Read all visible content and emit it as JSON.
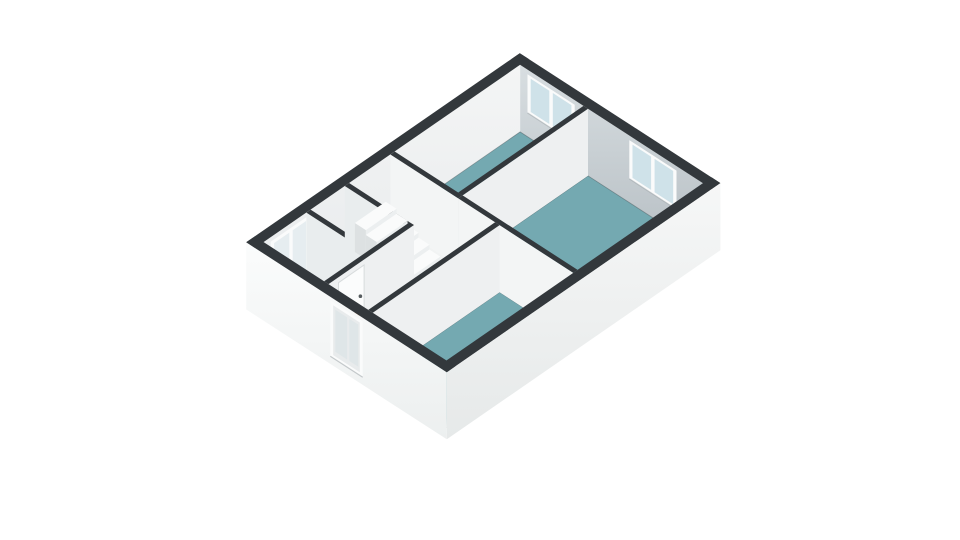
{
  "scene": {
    "background": "#ffffff",
    "type": "3d-floorplan-render"
  },
  "building": {
    "length_m": 9.6,
    "width_m": 6.8,
    "wall_height_m": 2.2,
    "exterior_wall_thickness_m": 0.3,
    "interior_wall_thickness_m": 0.15
  },
  "colors": {
    "wallTop": "#33383c",
    "teal": "#74a9b1",
    "floorWhite": "#f1f3f3",
    "floorEdge": "#3d464b",
    "faceBright": "#f3f5f5",
    "faceSouth": "#eef0f1",
    "faceWest": "#e9edee",
    "innerHi": "#d8dee1",
    "innerLo": "#b7bfc4",
    "y0Hi": "#f4f5f5",
    "y0Lo": "#e7eaec",
    "outerHi": "#fbfcfc",
    "outerLo": "#ecefef",
    "outer2Hi": "#f6f7f7",
    "outer2Lo": "#e6e9e9",
    "frame": "#fafbfb",
    "glass": "#cfe2e9",
    "glassLight": "#e6edf0",
    "paleGlass": "#dfe6e8",
    "sill": "#9aa2a6",
    "stripFill": "#edeff0",
    "seam": "#d9dddf",
    "stepTop": "#fafbfb",
    "stepFront": "#eceff0",
    "stepSide": "#dde1e2",
    "washTop": "#f3f5f5",
    "washFront": "#fdfdfd",
    "washSide": "#e9eced",
    "ringOuter": "#dfe3e4",
    "ringMid": "#97a1a5",
    "ringCore": "#c8cfd1",
    "leaf": "#fbfcfc",
    "leafEdge": "#d7dbdc",
    "handle": "#565c5f",
    "doorOrange": "#e08a3c"
  },
  "rooms": [
    {
      "id": "floor-bedroom-1",
      "label": "bedroom-top",
      "floor": "teal",
      "rect": [
        4.9,
        0.3,
        4.4,
        2.15
      ]
    },
    {
      "id": "floor-bedroom-2",
      "label": "bedroom-large",
      "floor": "teal",
      "rect": [
        4.9,
        2.6,
        4.4,
        3.9
      ]
    },
    {
      "id": "floor-bathroom",
      "label": "bathroom",
      "floor": "teal",
      "rect": [
        0.3,
        4.0,
        4.45,
        2.5
      ]
    },
    {
      "id": "floor-study",
      "label": "corner-room",
      "floor": "white",
      "rect": [
        0.3,
        0.3,
        1.5,
        2.05
      ]
    },
    {
      "id": "floor-wc",
      "label": "small-room",
      "floor": "white",
      "rect": [
        1.95,
        0.3,
        1.2,
        2.05
      ]
    },
    {
      "id": "floor-stairwell",
      "label": "stairwell",
      "floor": "white",
      "rect": [
        3.3,
        0.3,
        1.45,
        2.05
      ]
    },
    {
      "id": "floor-landing",
      "label": "landing-hall",
      "floor": "white",
      "rect": [
        0.3,
        2.5,
        4.45,
        1.35
      ]
    }
  ],
  "interior_walls": [
    {
      "id": "wall-w1",
      "rect": [
        4.9,
        2.45,
        4.4,
        0.15
      ]
    },
    {
      "id": "wall-end-a",
      "rect": [
        4.75,
        0.3,
        0.15,
        2.3
      ]
    },
    {
      "id": "wall-study-east",
      "rect": [
        1.8,
        0.3,
        0.15,
        2.05
      ]
    },
    {
      "id": "wall-bay",
      "rect": [
        3.15,
        0.3,
        0.15,
        2.05
      ]
    },
    {
      "id": "wall-south",
      "rect": [
        0.3,
        2.35,
        3.0,
        0.15
      ]
    },
    {
      "id": "wall-w2",
      "rect": [
        4.75,
        2.6,
        0.15,
        3.9
      ]
    },
    {
      "id": "wall-bathroom",
      "rect": [
        0.3,
        3.85,
        4.45,
        0.15
      ]
    }
  ],
  "windows": [
    {
      "id": "window-bedroom-1",
      "plane": "x",
      "at": 9.3,
      "frame": [
        0.55,
        2.15,
        0.78,
        2.05
      ],
      "panes": [
        [
          0.66,
          1.29
        ],
        [
          1.41,
          2.04
        ]
      ],
      "pane_z": [
        0.88,
        1.97
      ],
      "glass": "glass"
    },
    {
      "id": "window-bedroom-2",
      "plane": "x",
      "at": 9.3,
      "frame": [
        4.0,
        5.6,
        0.78,
        2.05
      ],
      "panes": [
        [
          4.11,
          4.74
        ],
        [
          4.86,
          5.49
        ]
      ],
      "pane_z": [
        0.88,
        1.97
      ],
      "glass": "glass"
    },
    {
      "id": "window-study",
      "plane": "y",
      "at": 0.3,
      "frame": [
        0.55,
        1.9,
        0.2,
        2.05
      ],
      "panes": [
        [
          0.67,
          1.2
        ],
        [
          1.32,
          1.79
        ]
      ],
      "pane_z": [
        0.35,
        1.93
      ],
      "glass": "glassLight"
    },
    {
      "id": "window-landing",
      "plane": "x",
      "at": 0.0,
      "frame": [
        2.85,
        3.95,
        0.25,
        2.08
      ],
      "inner": [
        2.95,
        3.85,
        0.35,
        1.98
      ],
      "panes": [
        [
          3.02,
          3.42
        ],
        [
          3.5,
          3.8
        ]
      ],
      "pane_z": [
        0.5,
        1.88
      ],
      "glass": "paleGlass"
    }
  ],
  "stairs": {
    "id": "staircase",
    "x0": 3.35,
    "x1": 4.43,
    "y_start": 0.45,
    "step_depth": 0.37,
    "step_tops": [
      0.95,
      0.79,
      0.63,
      0.47,
      0.31
    ]
  },
  "furniture": [
    {
      "id": "washing-machine",
      "kind": "washer",
      "box": [
        0.45,
        4.15,
        0.7,
        0.7,
        0.85
      ],
      "door_center": [
        4.5,
        0.42
      ],
      "door_r": [
        0.27,
        0.165,
        0.07
      ]
    },
    {
      "id": "cabinet",
      "kind": "box",
      "box": [
        0.45,
        4.95,
        0.55,
        0.5,
        0.55
      ]
    }
  ],
  "doors": [
    {
      "id": "door-study",
      "kind": "leaf-on-south-wall",
      "plane_y": 2.5,
      "leaf": [
        0.65,
        1.55,
        0.08,
        2.02
      ],
      "handle": [
        1.42,
        1.08
      ]
    },
    {
      "id": "door-open-orange",
      "kind": "sliver",
      "at_x": 1.08,
      "y": [
        2.63,
        2.8
      ],
      "z": [
        0.75,
        1.2
      ]
    }
  ],
  "bottom_wall_panels": {
    "x_from": 0.55,
    "x_to": 3.55,
    "spacing": 0.5
  },
  "paint_order": [
    "wall-right",
    "wall-top",
    "floor-bedroom-1",
    "floor-bedroom-2",
    "floor-study",
    "floor-wc",
    "floor-stairwell",
    "floor-landing",
    "floor-bathroom",
    "wall-w1",
    "wall-end-a",
    "wall-study-east",
    "wall-bay",
    "staircase",
    "wall-south",
    "door-study",
    "door-open-orange",
    "wall-w2",
    "wall-bathroom",
    "washing-machine",
    "cabinet",
    "wall-bottom",
    "wall-left"
  ]
}
